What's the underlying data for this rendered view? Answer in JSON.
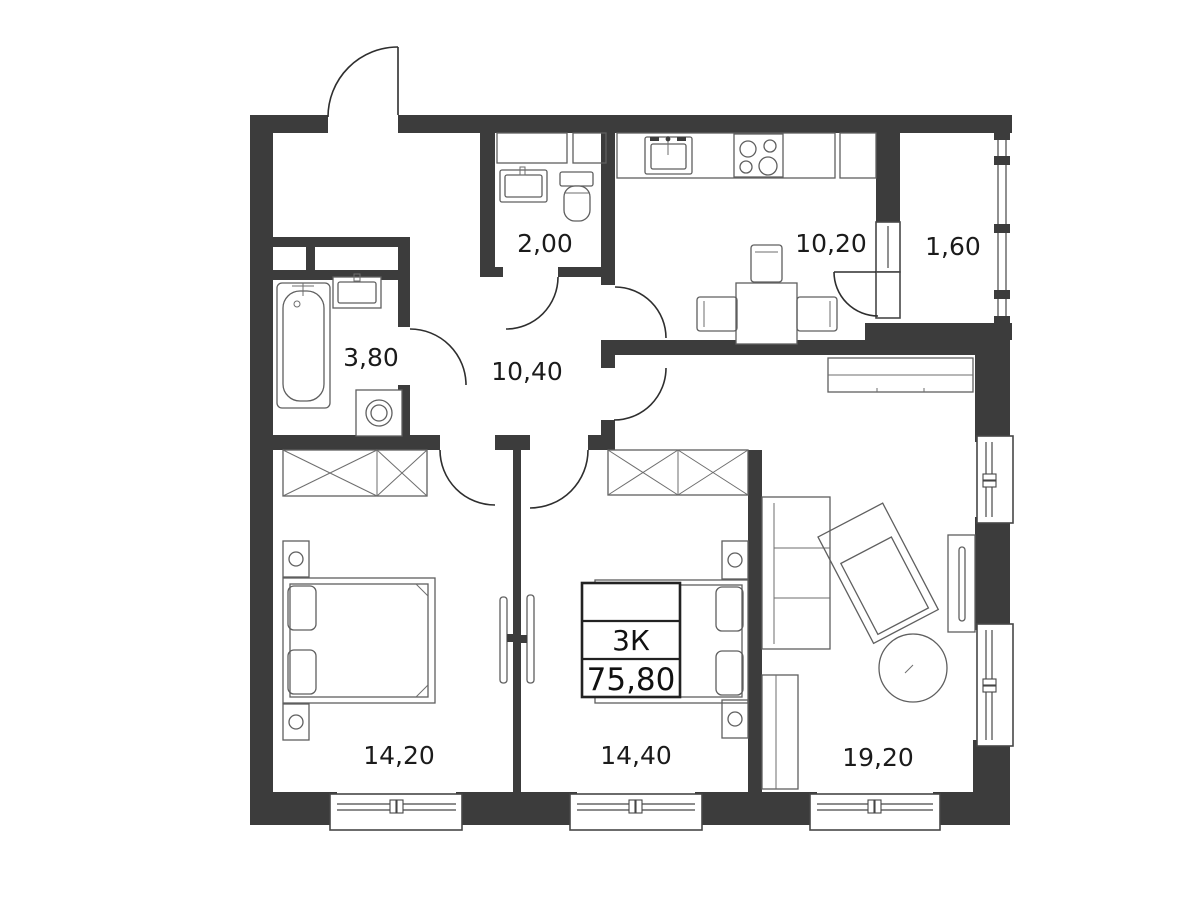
{
  "plan": {
    "summary": {
      "type_label": "3К",
      "total_area": "75,80"
    },
    "rooms": [
      {
        "id": "wc",
        "area": "2,00"
      },
      {
        "id": "kitchen",
        "area": "10,20"
      },
      {
        "id": "balcony",
        "area": "1,60"
      },
      {
        "id": "bathroom",
        "area": "3,80"
      },
      {
        "id": "hallway",
        "area": "10,40"
      },
      {
        "id": "bedroom-1",
        "area": "14,20"
      },
      {
        "id": "bedroom-2",
        "area": "14,40"
      },
      {
        "id": "living-room",
        "area": "19,20"
      }
    ],
    "colors": {
      "wall": "#3c3c3c",
      "furniture_line": "#5f5f5f",
      "text": "#1b1b1b",
      "background": "#ffffff"
    }
  }
}
